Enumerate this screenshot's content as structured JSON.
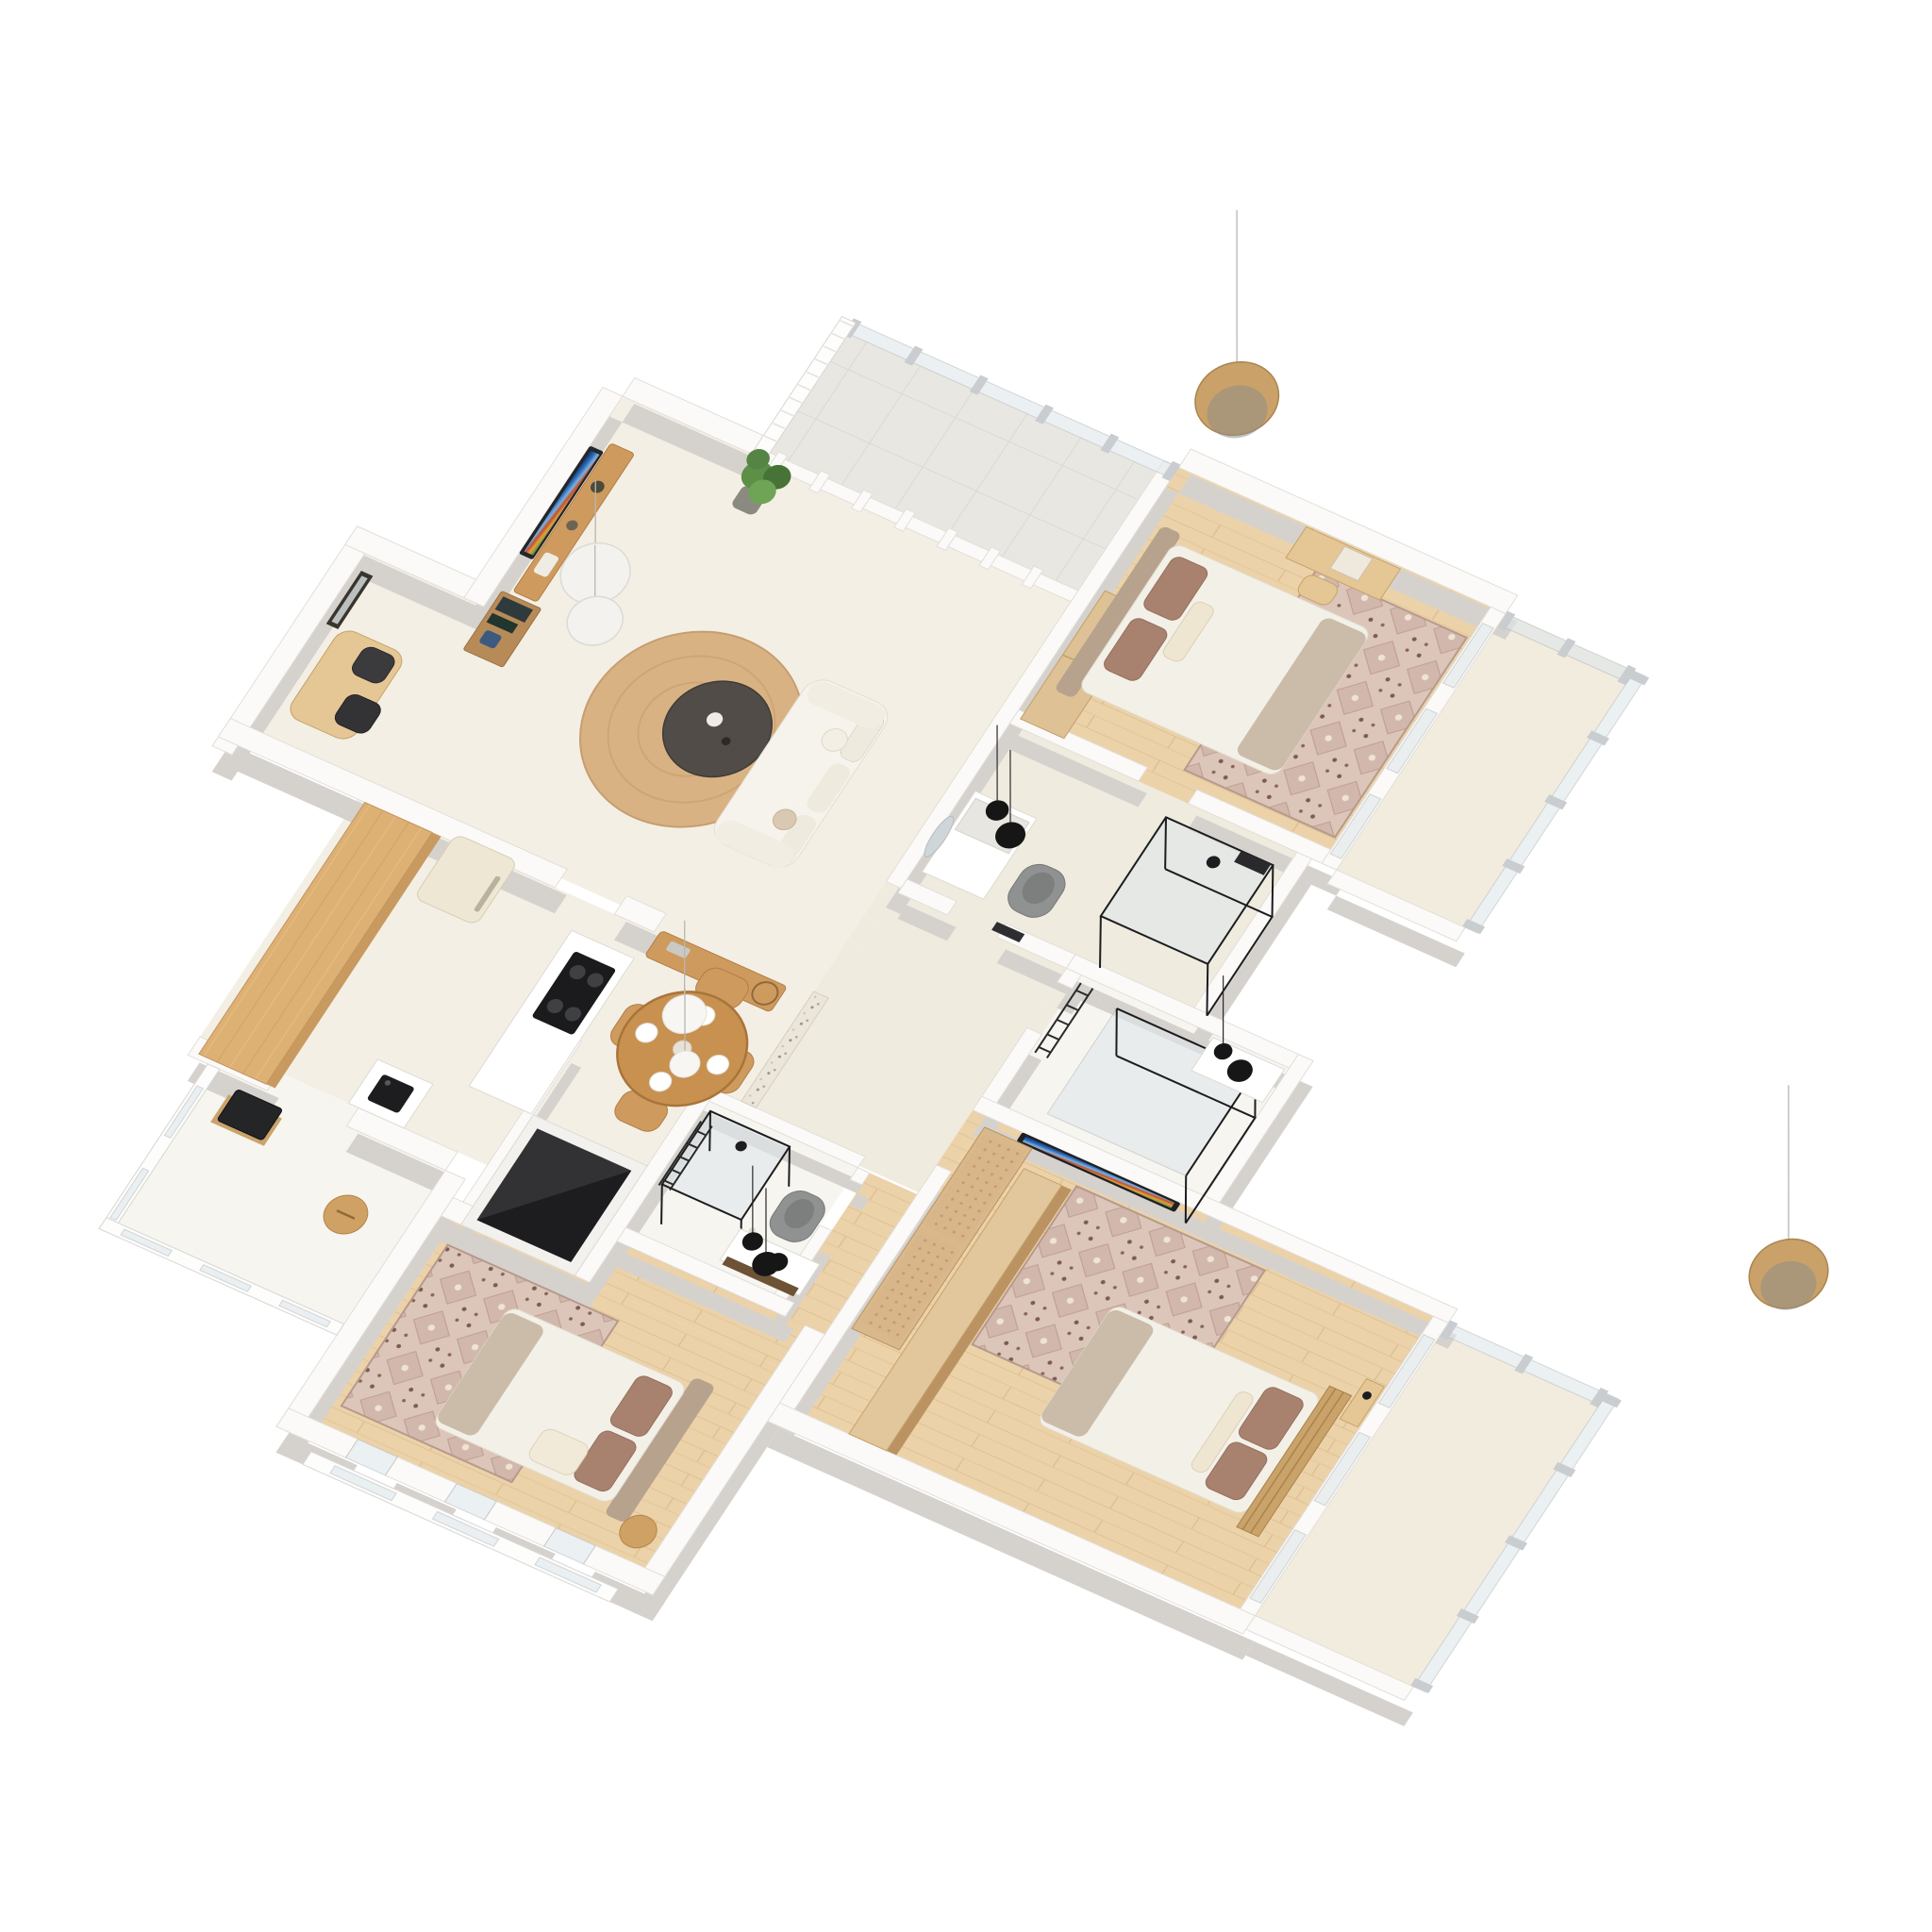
{
  "scene": {
    "title": "3D Isometric Apartment Floor Plan Render",
    "type": "architectural-render",
    "background": "#ffffff",
    "description": "Top-down 3D rendering of a three-bedroom apartment with living room, office nook, kitchen, dining area, three bathrooms, three bedrooms, two balconies, a terrace and hanging wood disc pendant lights."
  },
  "palette": {
    "bg": "#ffffff",
    "wall": "#fbfaf8",
    "wallStroke": "#e2dfd9",
    "wallShadow": "#d5d2ce",
    "floorCream": "#f4efe5",
    "tile": "#e9e7e2",
    "woodFloor": "#ecd2a9",
    "woodFurn": "#cf9a5e",
    "island": "#ddb074",
    "cane": "#d8b68a",
    "fridge": "#eee7d4",
    "sofa": "#f6f3ec",
    "mattress": "#f3f0e8",
    "pillow": "#a8826e",
    "taupe": "#cbbcaa",
    "rugBase": "#dcc6ba",
    "jute": "#d9b284",
    "coffeeTable": "#514c47",
    "black": "#1b1b1d",
    "toilet": "#8f9290",
    "glass": "#dfe7ea",
    "plant": "#5d8f46",
    "discPendant": "#c9a169"
  },
  "rooms": [
    {
      "id": "terrace",
      "label": "Terrace",
      "floor": "tile",
      "features": [
        "glass-railing",
        "slat-screen"
      ]
    },
    {
      "id": "living-room",
      "label": "Living Room",
      "floor": "cream",
      "furniture": [
        "wall-tv",
        "media-console",
        "shelf-unit",
        "potted-plant",
        "white-sofa",
        "dark-coffee-table",
        "jute-rug",
        "white-disc-pendants"
      ]
    },
    {
      "id": "office-nook",
      "label": "Office Nook",
      "floor": "cream",
      "furniture": [
        "wood-desk",
        "two-black-chairs",
        "leaning-mirror"
      ]
    },
    {
      "id": "kitchen",
      "label": "Kitchen",
      "floor": "cream",
      "furniture": [
        "wood-island",
        "retro-fridge",
        "black-cooktop",
        "sink-unit"
      ]
    },
    {
      "id": "kitchen-balcony",
      "label": "Kitchen Balcony",
      "floor": "white",
      "furniture": [
        "wood-stool",
        "dark-appliance-box"
      ]
    },
    {
      "id": "dining-area",
      "label": "Dining Area",
      "floor": "cream",
      "furniture": [
        "round-wood-table",
        "four-chairs",
        "tableware",
        "white-globe-pendants",
        "bar-cart",
        "stone-accent-wall"
      ]
    },
    {
      "id": "utility-enclosure",
      "label": "Dark Storage Enclosure",
      "floor": "cream",
      "furniture": [
        "dark-box"
      ]
    },
    {
      "id": "master-bedroom",
      "label": "Master Bedroom",
      "floor": "wood",
      "furniture": [
        "double-bed",
        "patterned-rug",
        "vanity-desk",
        "wardrobe",
        "wood-disc-pendant"
      ]
    },
    {
      "id": "master-balcony",
      "label": "Master Balcony",
      "floor": "light",
      "features": [
        "glass-railing"
      ]
    },
    {
      "id": "ensuite-bathroom",
      "label": "Ensuite Bathroom",
      "floor": "white",
      "furniture": [
        "glass-shower",
        "vanity-with-black-pendants",
        "gray-toilet",
        "towel-ladder",
        "round-mirror"
      ]
    },
    {
      "id": "hallway",
      "label": "Hallway",
      "floor": "cream"
    },
    {
      "id": "bathroom-two",
      "label": "Bathroom Two",
      "floor": "white",
      "furniture": [
        "glass-partition",
        "black-sink-counter",
        "towel-ladder",
        "wall-tv"
      ]
    },
    {
      "id": "central-bathroom",
      "label": "Central Bathroom",
      "floor": "white",
      "furniture": [
        "glass-shower",
        "gray-toilet",
        "vanity-with-black-pendants",
        "towel-ladder"
      ]
    },
    {
      "id": "bedroom-two",
      "label": "Bedroom Two",
      "floor": "wood",
      "furniture": [
        "double-bed",
        "patterned-rug",
        "round-side-table",
        "french-windows"
      ]
    },
    {
      "id": "bedroom-three",
      "label": "Bedroom Three",
      "floor": "wood",
      "furniture": [
        "double-bed",
        "patterned-rug",
        "cane-wardrobe",
        "tall-wood-wardrobe",
        "bedside-shelf"
      ]
    },
    {
      "id": "bedroom-three-balcony",
      "label": "Bedroom Three Balcony",
      "floor": "light",
      "features": [
        "glass-railing",
        "wood-disc-pendant"
      ]
    }
  ]
}
